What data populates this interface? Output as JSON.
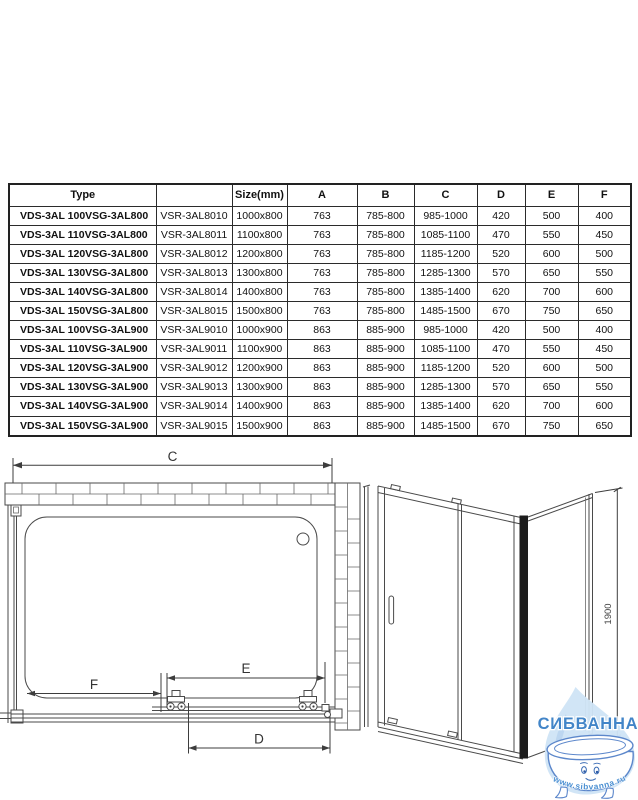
{
  "table": {
    "headers": [
      "Type",
      "",
      "Size(mm)",
      "A",
      "B",
      "C",
      "D",
      "E",
      "F"
    ],
    "rows": [
      {
        "t1": "VDS-3AL 100",
        "t2": "VSG-3AL800",
        "code": "VSR-3AL8010",
        "size": "1000x800",
        "a": "763",
        "b": "785-800",
        "c": "985-1000",
        "d": "420",
        "e": "500",
        "f": "400"
      },
      {
        "t1": "VDS-3AL 110",
        "t2": "VSG-3AL800",
        "code": "VSR-3AL8011",
        "size": "1100x800",
        "a": "763",
        "b": "785-800",
        "c": "1085-1100",
        "d": "470",
        "e": "550",
        "f": "450"
      },
      {
        "t1": "VDS-3AL 120",
        "t2": "VSG-3AL800",
        "code": "VSR-3AL8012",
        "size": "1200x800",
        "a": "763",
        "b": "785-800",
        "c": "1185-1200",
        "d": "520",
        "e": "600",
        "f": "500"
      },
      {
        "t1": "VDS-3AL 130",
        "t2": "VSG-3AL800",
        "code": "VSR-3AL8013",
        "size": "1300x800",
        "a": "763",
        "b": "785-800",
        "c": "1285-1300",
        "d": "570",
        "e": "650",
        "f": "550"
      },
      {
        "t1": "VDS-3AL 140",
        "t2": "VSG-3AL800",
        "code": "VSR-3AL8014",
        "size": "1400x800",
        "a": "763",
        "b": "785-800",
        "c": "1385-1400",
        "d": "620",
        "e": "700",
        "f": "600"
      },
      {
        "t1": "VDS-3AL 150",
        "t2": "VSG-3AL800",
        "code": "VSR-3AL8015",
        "size": "1500x800",
        "a": "763",
        "b": "785-800",
        "c": "1485-1500",
        "d": "670",
        "e": "750",
        "f": "650"
      },
      {
        "t1": "VDS-3AL 100",
        "t2": "VSG-3AL900",
        "code": "VSR-3AL9010",
        "size": "1000x900",
        "a": "863",
        "b": "885-900",
        "c": "985-1000",
        "d": "420",
        "e": "500",
        "f": "400"
      },
      {
        "t1": "VDS-3AL 110",
        "t2": "VSG-3AL900",
        "code": "VSR-3AL9011",
        "size": "1100x900",
        "a": "863",
        "b": "885-900",
        "c": "1085-1100",
        "d": "470",
        "e": "550",
        "f": "450"
      },
      {
        "t1": "VDS-3AL 120",
        "t2": "VSG-3AL900",
        "code": "VSR-3AL9012",
        "size": "1200x900",
        "a": "863",
        "b": "885-900",
        "c": "1185-1200",
        "d": "520",
        "e": "600",
        "f": "500"
      },
      {
        "t1": "VDS-3AL 130",
        "t2": "VSG-3AL900",
        "code": "VSR-3AL9013",
        "size": "1300x900",
        "a": "863",
        "b": "885-900",
        "c": "1285-1300",
        "d": "570",
        "e": "650",
        "f": "550"
      },
      {
        "t1": "VDS-3AL 140",
        "t2": "VSG-3AL900",
        "code": "VSR-3AL9014",
        "size": "1400x900",
        "a": "863",
        "b": "885-900",
        "c": "1385-1400",
        "d": "620",
        "e": "700",
        "f": "600"
      },
      {
        "t1": "VDS-3AL 150",
        "t2": "VSG-3AL900",
        "code": "VSR-3AL9015",
        "size": "1500x900",
        "a": "863",
        "b": "885-900",
        "c": "1485-1500",
        "d": "670",
        "e": "750",
        "f": "650"
      }
    ]
  },
  "plan_view": {
    "labels": {
      "c": "C",
      "f": "F",
      "e": "E",
      "d": "D"
    }
  },
  "front_view": {
    "height_label": "1900"
  },
  "watermark": {
    "brand": "СИБВАННА",
    "url": "www.sibvanna.ru",
    "text_color": "#4285c8",
    "drop_color": "#cfe4f6",
    "outline_color": "#5c87cb"
  }
}
